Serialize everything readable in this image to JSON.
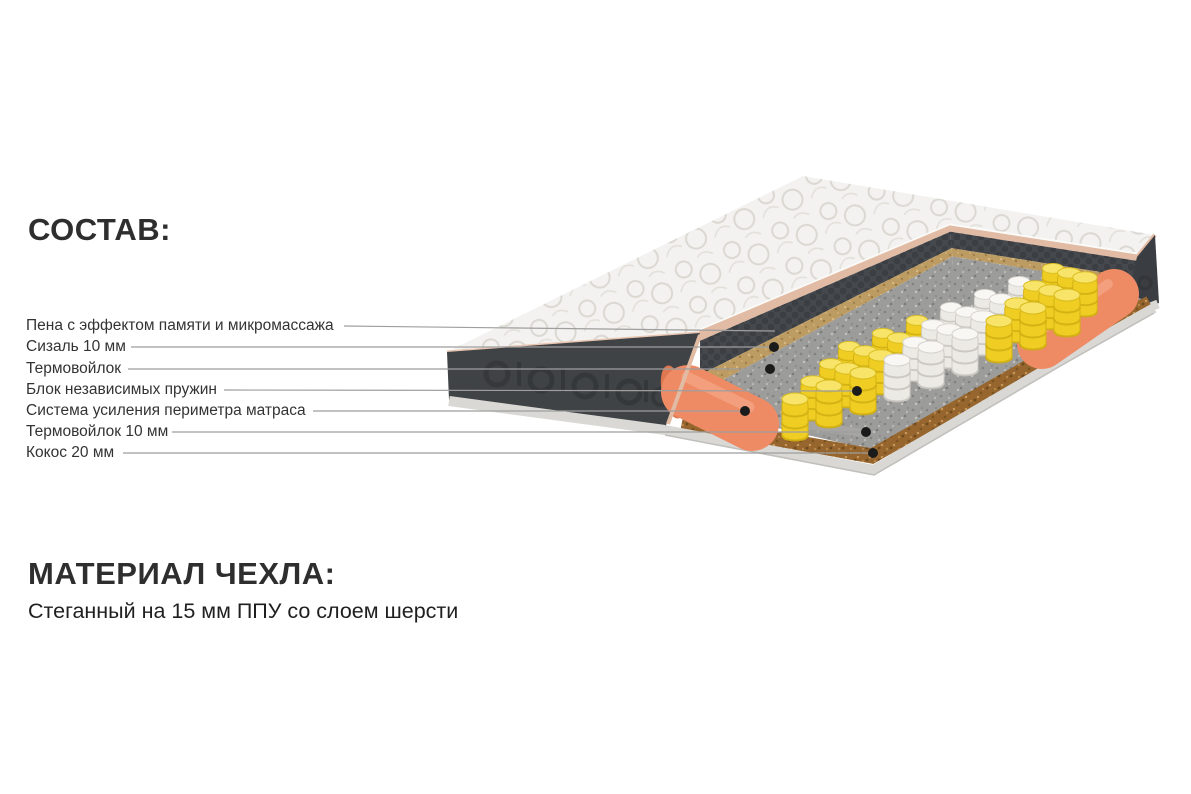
{
  "composition": {
    "heading": "СОСТАВ:",
    "items": [
      {
        "label": "Пена с эффектом памяти и микромассажа",
        "layer": "memory-foam-micromassage"
      },
      {
        "label": "Сизаль 10 мм",
        "layer": "sisal-10mm"
      },
      {
        "label": "Термовойлок",
        "layer": "thermo-felt-top"
      },
      {
        "label": "Блок независимых пружин",
        "layer": "independent-spring-block"
      },
      {
        "label": "Система усиления периметра матраса",
        "layer": "perimeter-reinforcement"
      },
      {
        "label": "Термовойлок 10 мм",
        "layer": "thermo-felt-10mm"
      },
      {
        "label": "Кокос 20 мм",
        "layer": "coconut-20mm"
      }
    ]
  },
  "cover_material": {
    "heading": "МАТЕРИАЛ ЧЕХЛА:",
    "description": "Стеганный на 15 мм ППУ со слоем шерсти"
  },
  "illustration": {
    "name": "mattress-cutaway-3d",
    "colors": {
      "cover": "#f3f2f0",
      "cover_pattern": "#dbd8d2",
      "trim": "#e2bba4",
      "side_panel": "#404346",
      "memory_foam": "#45484c",
      "sisal": "#bd9c63",
      "felt": "#9c9c9a",
      "spring_yellow": "#efcd22",
      "spring_white": "#eceae5",
      "perimeter_foam": "#ee8a64",
      "coconut": "#96662e",
      "piping": "#d9d8d5",
      "leader_line": "#9e9e9e",
      "dot": "#1b1b1b",
      "text": "#2e2e2e"
    }
  }
}
